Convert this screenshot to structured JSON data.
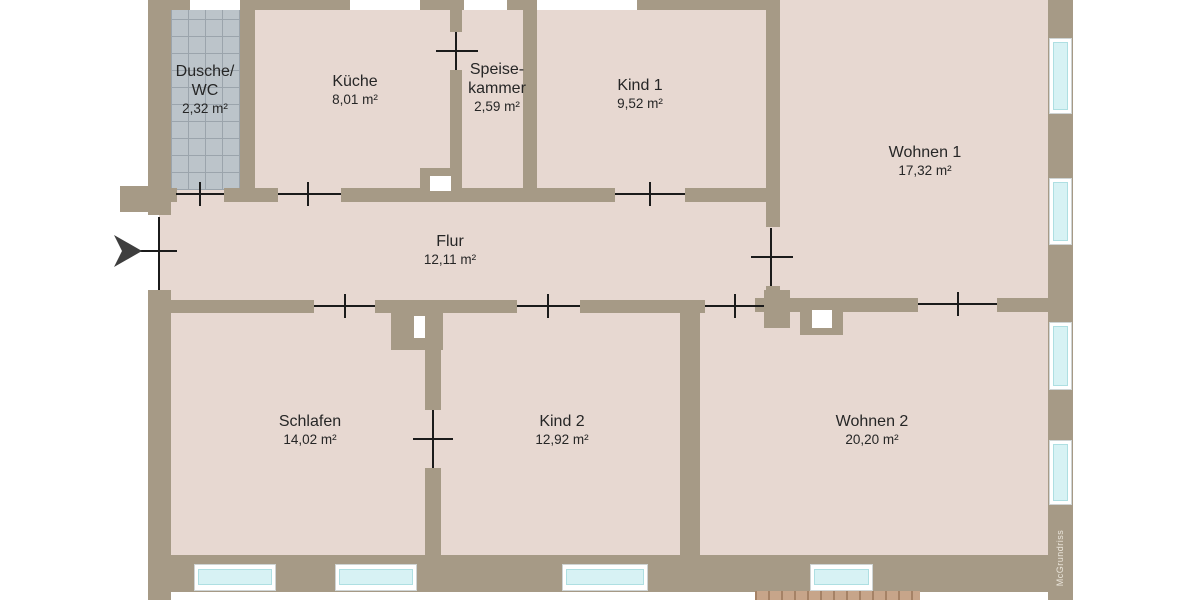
{
  "watermark": "McGrundriss",
  "colors": {
    "outside": "#ffffff",
    "wall": "#a69a86",
    "floor": "#e7d8d1",
    "tile": "#bcc4ca",
    "tile_line": "#9ba4ac",
    "window_frame": "#ffffff",
    "window_glass": "#d7f2f4",
    "door_line": "#1b1b1b",
    "deck": "#c7a58a",
    "deck_line": "#a58266",
    "label": "#262626",
    "watermark_text": "#eae5da",
    "arrow": "#3e3e3e"
  },
  "rooms": [
    {
      "key": "dusche-wc",
      "name_parts": [
        "Dusche/",
        "WC"
      ],
      "area": "2,32 m²"
    },
    {
      "key": "kueche",
      "name_parts": [
        "Küche"
      ],
      "area": "8,01 m²"
    },
    {
      "key": "speisekammer",
      "name_parts": [
        "Speise-",
        "kammer"
      ],
      "area": "2,59 m²"
    },
    {
      "key": "kind-1",
      "name_parts": [
        "Kind 1"
      ],
      "area": "9,52 m²"
    },
    {
      "key": "wohnen-1",
      "name_parts": [
        "Wohnen 1"
      ],
      "area": "17,32 m²"
    },
    {
      "key": "flur",
      "name_parts": [
        "Flur"
      ],
      "area": "12,11 m²"
    },
    {
      "key": "schlafen",
      "name_parts": [
        "Schlafen"
      ],
      "area": "14,02 m²"
    },
    {
      "key": "kind-2",
      "name_parts": [
        "Kind 2"
      ],
      "area": "12,92 m²"
    },
    {
      "key": "wohnen-2",
      "name_parts": [
        "Wohnen 2"
      ],
      "area": "20,20 m²"
    }
  ]
}
